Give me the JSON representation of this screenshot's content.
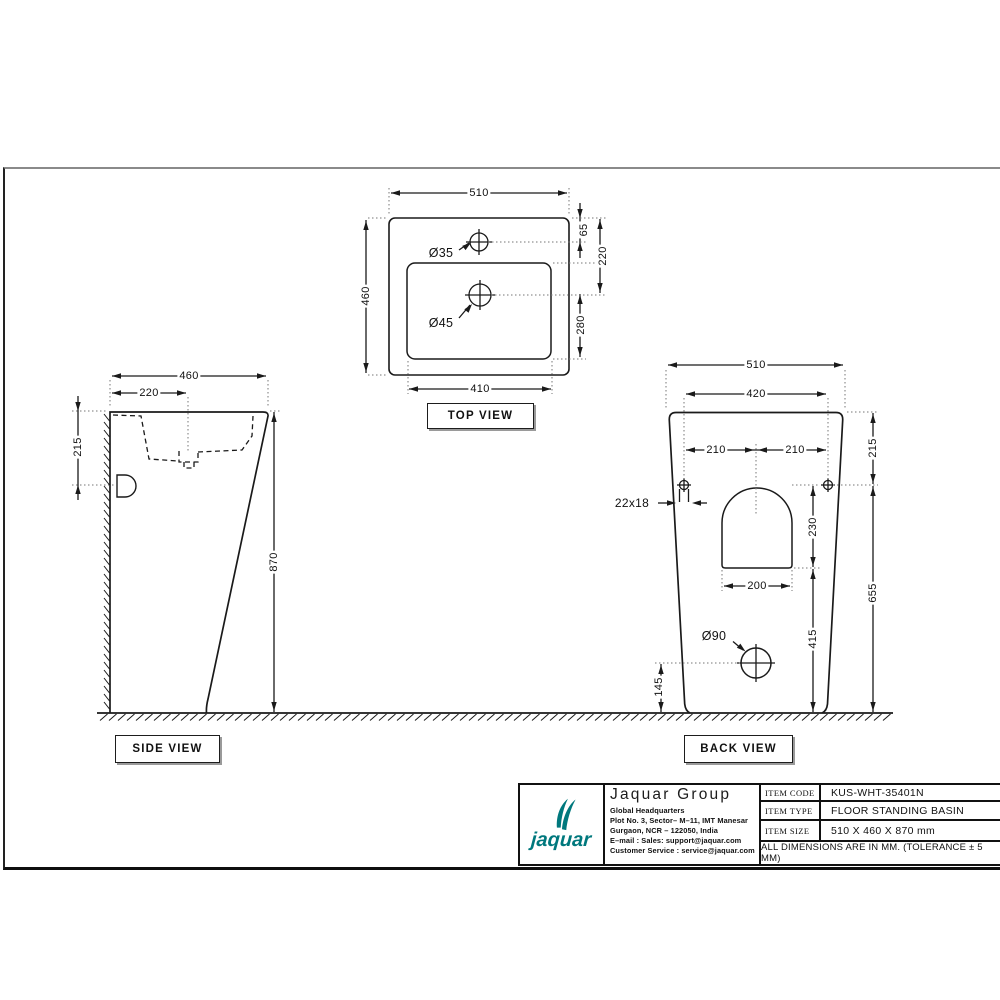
{
  "colors": {
    "accent": "#00787D",
    "line": "#1a1a1a"
  },
  "views": {
    "top": {
      "label": "TOP VIEW",
      "dim_width": "510",
      "dim_depth": "460",
      "dim_hole_offset": "65",
      "dim_drain_offset": "220",
      "dim_bowl_depth": "280",
      "dim_bowl_width": "410",
      "faucet_hole": "Ø35",
      "drain_hole": "Ø45"
    },
    "side": {
      "label": "SIDE VIEW",
      "dim_depth": "460",
      "dim_drain_offset": "220",
      "dim_rim_depth": "215",
      "dim_height": "870"
    },
    "back": {
      "label": "BACK VIEW",
      "dim_width": "510",
      "dim_fix_span": "420",
      "dim_fix_half_left": "210",
      "dim_fix_half_right": "210",
      "dim_fix_drop": "215",
      "fix_slot": "22x18",
      "dim_arch_height": "230",
      "dim_arch_width": "200",
      "drain_hole": "Ø90",
      "dim_drain_to_arch": "415",
      "dim_drain_height": "145",
      "dim_lower_height": "655"
    }
  },
  "title_block": {
    "logo_text": "jaquar",
    "company": "Jaquar Group",
    "hq": "Global Headquarters",
    "addr1": "Plot No. 3, Sector– M–11, IMT Manesar",
    "addr2": "Gurgaon, NCR – 122050, India",
    "email": "E–mail : Sales: support@jaquar.com",
    "service": "Customer Service : service@jaquar.com",
    "rows": [
      {
        "label": "ITEM CODE",
        "value": "KUS-WHT-35401N"
      },
      {
        "label": "ITEM TYPE",
        "value": "FLOOR STANDING BASIN"
      },
      {
        "label": "ITEM SIZE",
        "value": "510 X 460 X 870 mm"
      }
    ],
    "note": "ALL DIMENSIONS ARE IN MM. (TOLERANCE ± 5 MM)"
  }
}
